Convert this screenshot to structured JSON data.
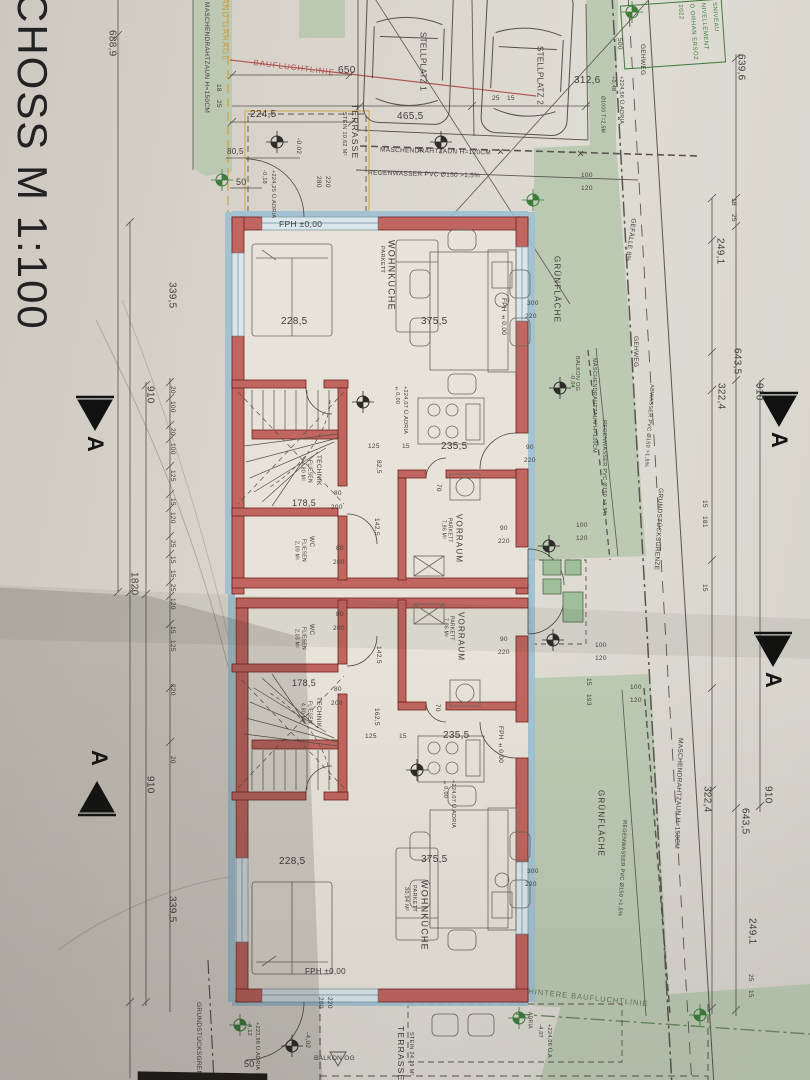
{
  "t": {
    "title": "CHOSS M 1:100",
    "stellplatz1": "STELLPLATZ 1",
    "stellplatz2": "STELLPLATZ 2",
    "terrasse": "TERRASSE",
    "stein_1062": "STEIN 10,62 M²",
    "stein_2419": "STEIN 24,19 M²",
    "balkon_og": "BALKON OG",
    "gruenflaeche": "GRÜNFLÄCHE",
    "gehweg": "GEHWEG",
    "gefaelle": "GEFÄLLE 8%",
    "zaun120": "MASCHENDRAHTZAUN H=120CM",
    "zaun150": "MASCHENDRAHTZAUN H=150CM",
    "regenwasser": "REGENWASSER PVC Ø150 >1,5%",
    "abwasser": "ABWASSER PVC Ø150 >1,5%",
    "grenze": "GRUNDSTÜCKSGRENZE",
    "bauflucht": "BAUFLUCHTLINIE",
    "hintere": "HINTERE BAUFLUCHTLINIE",
    "abstand": "ABSTAND GARAGE",
    "baum": "Ø1000 T=2,5M",
    "wohnkueche": "WOHNKÜCHE",
    "parkett": "PARKETT",
    "a3094": "30,94 M²",
    "vorraum": "VORRAUM",
    "a786": "7,86 M²",
    "wc": "WC",
    "fliesen": "FLIESEN",
    "a209": "2,09 M²",
    "a203": "2,03 M²",
    "technik": "TECHNIK",
    "a480": "4,80 M²",
    "fph": "FPH ±0,00",
    "section": "A"
  },
  "stamp": {
    "l1": "SNIVEAU",
    "l2": "NIVELLEMENT",
    "l3": "O ORHAN ERSÖZ",
    "l4": "2022"
  },
  "lv": {
    "m002": "-0,02",
    "m018": "-0,18",
    "p22425": "+224,25 Ü.ADRIA",
    "pm000": "±0,00",
    "p22407": "+224,07 Ü.ADRIA",
    "m004": "-0,04",
    "m402": "-4,02",
    "m412": "-4,12",
    "p22398": "+223,98 Ü.ADRIA",
    "m407": "-4,07",
    "p22406": "+224,06 Ü.A",
    "p048": "+0,48",
    "p22456": "+224,56 Ü.ADRIA",
    "adria": "ADRIA"
  },
  "d": {
    "n6889": "688,9",
    "n650": "650",
    "n2245": "224,5",
    "n805": "80,5",
    "n50": "50",
    "n18": "18",
    "n25": "25",
    "n4655": "465,5",
    "n15": "15",
    "n3126": "312,6",
    "n100": "100",
    "n120": "120",
    "n6396": "639,6",
    "n2491": "249,1",
    "n6435": "643,5",
    "n3224": "322,4",
    "n910": "910",
    "n1820": "1820",
    "n3395": "339,5",
    "n20": "20",
    "n125": "125",
    "n2285": "228,5",
    "n3755": "375,5",
    "n2355": "235,5",
    "n825": "82,5",
    "n70": "70",
    "n1785": "178,5",
    "n80": "80",
    "n200": "200",
    "n1425": "142,5",
    "n1625": "162,5",
    "n90": "90",
    "n220": "220",
    "n280": "280",
    "n300": "300",
    "n193": "193",
    "n181": "181",
    "n500": "500"
  }
}
